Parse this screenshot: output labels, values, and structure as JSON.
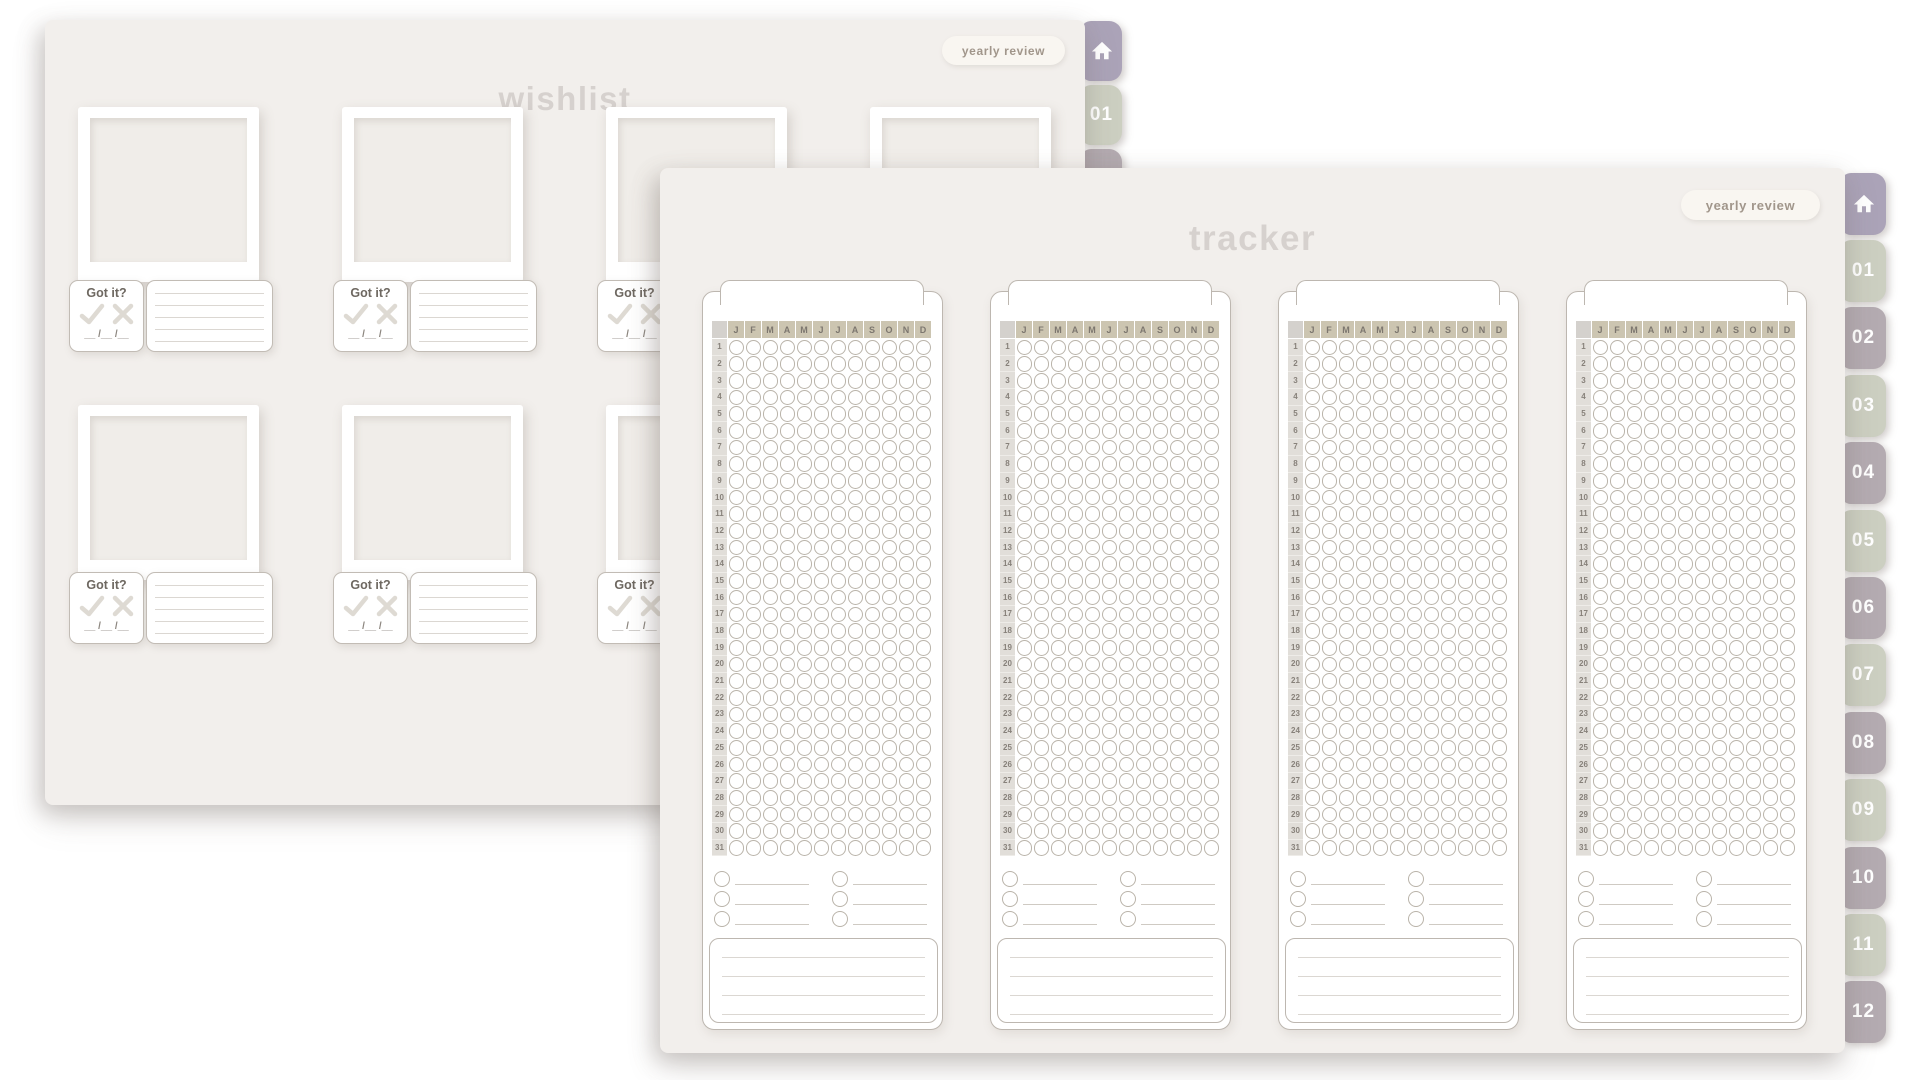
{
  "palette": {
    "page_bg": "#f2efec",
    "title_text": "#d6d1ce",
    "pill_bg": "#f9f6f1",
    "pill_text": "#a1968b",
    "tab_home": "#aba3b8",
    "tab_sage": "#cccfc1",
    "tab_mauve": "#b4abb1",
    "tab_text": "#ffffff",
    "tan_header": "#ccc5b1",
    "icon_stroke": "#dedad3"
  },
  "wishlist": {
    "title": "wishlist",
    "yearly_review_label": "yearly review",
    "got_it_label": "Got it?",
    "date_placeholder": "__ /__ /__",
    "item_count": 8,
    "note_lines_per_item": 5,
    "tabs": [
      {
        "type": "home",
        "label": ""
      },
      {
        "type": "number",
        "label": "01"
      },
      {
        "type": "number",
        "label": "02"
      }
    ]
  },
  "tracker": {
    "title": "tracker",
    "yearly_review_label": "yearly review",
    "months": [
      "J",
      "F",
      "M",
      "A",
      "M",
      "J",
      "J",
      "A",
      "S",
      "O",
      "N",
      "D"
    ],
    "days": [
      1,
      2,
      3,
      4,
      5,
      6,
      7,
      8,
      9,
      10,
      11,
      12,
      13,
      14,
      15,
      16,
      17,
      18,
      19,
      20,
      21,
      22,
      23,
      24,
      25,
      26,
      27,
      28,
      29,
      30,
      31
    ],
    "card_count": 4,
    "legend_rows_per_column": 3,
    "legend_columns": 2,
    "note_lines_per_card": 4,
    "tabs": [
      {
        "type": "home",
        "label": ""
      },
      {
        "type": "number",
        "label": "01"
      },
      {
        "type": "number",
        "label": "02"
      },
      {
        "type": "number",
        "label": "03"
      },
      {
        "type": "number",
        "label": "04"
      },
      {
        "type": "number",
        "label": "05"
      },
      {
        "type": "number",
        "label": "06"
      },
      {
        "type": "number",
        "label": "07"
      },
      {
        "type": "number",
        "label": "08"
      },
      {
        "type": "number",
        "label": "09"
      },
      {
        "type": "number",
        "label": "10"
      },
      {
        "type": "number",
        "label": "11"
      },
      {
        "type": "number",
        "label": "12"
      }
    ]
  }
}
